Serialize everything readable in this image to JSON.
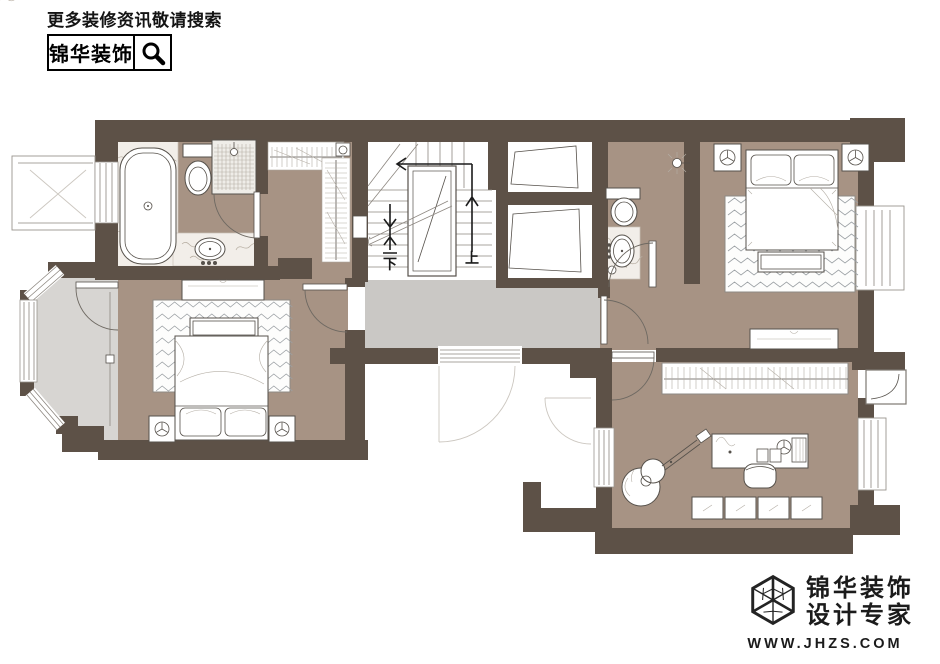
{
  "header": {
    "tagline": "更多装修资讯敬请搜索",
    "brand": "锦华装饰"
  },
  "footer": {
    "brand_line1": "锦华装饰",
    "brand_line2": "设计专家",
    "website": "WWW.JHZS.COM"
  },
  "floorplan": {
    "stair_up_label": "上",
    "stair_down_label": "下",
    "colors": {
      "wall": "#5d5147",
      "floor": "#a79384",
      "hall_floor": "#cac8c5",
      "balcony_floor": "#d7d5d2",
      "marble": "#f2eee9"
    }
  }
}
